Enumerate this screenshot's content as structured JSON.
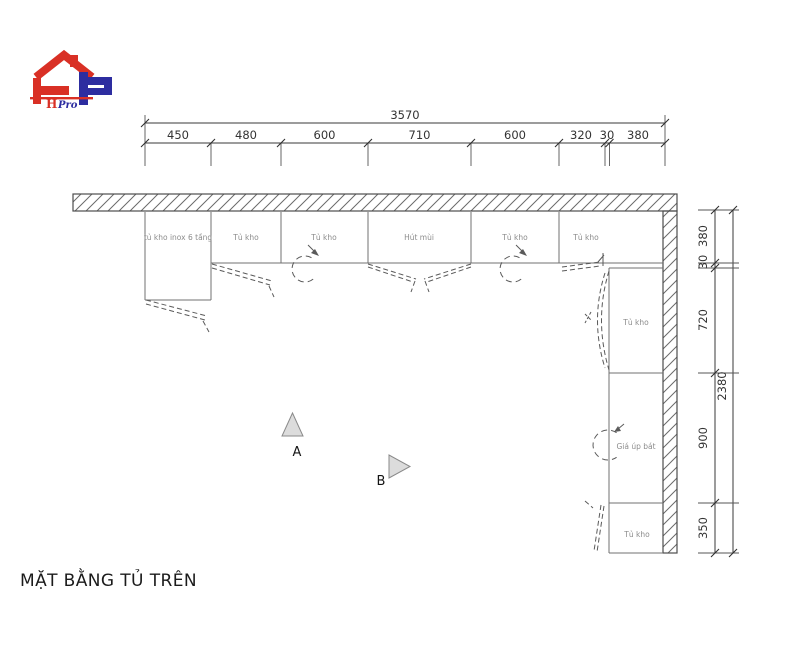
{
  "title": "MẶT BẰNG TỦ TRÊN",
  "logo": {
    "brand_h": "H",
    "brand_rest": "Pro",
    "red": "#d93025",
    "blue": "#2d2da0"
  },
  "dimensions": {
    "top_chain": {
      "total": "3570",
      "segments": [
        "450",
        "480",
        "600",
        "710",
        "600",
        "320",
        "30",
        "380"
      ]
    },
    "right_chain": {
      "total": "2380",
      "segments": [
        "380",
        "30",
        "720",
        "900",
        "350"
      ]
    }
  },
  "cabinets": {
    "top_row": [
      {
        "label": "tủ kho inox 6 tầng"
      },
      {
        "label": "Tủ kho"
      },
      {
        "label": "Tủ kho"
      },
      {
        "label": "Hút mùi"
      },
      {
        "label": "Tủ kho"
      },
      {
        "label": "Tủ kho"
      }
    ],
    "right_column": [
      {
        "label": "Tủ kho"
      },
      {
        "label": "Giá úp bát"
      },
      {
        "label": "Tủ kho"
      }
    ]
  },
  "markers": {
    "a": "A",
    "b": "B"
  },
  "colors": {
    "wall_line": "#4d4d4d",
    "hatch_line": "#6a6a6a",
    "cabinet_line": "#707070",
    "dim_line": "#3a3a3a",
    "label_text": "#8c8c8c",
    "marker_fill": "#dcdcdc"
  }
}
